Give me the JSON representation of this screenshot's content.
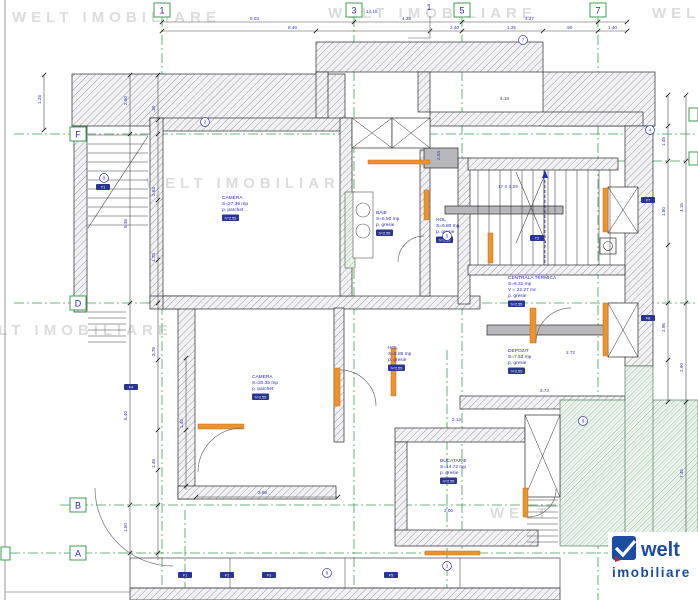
{
  "watermark": {
    "text": "WELT IMOBILIARE",
    "color": "#dcdcdc",
    "positions": [
      {
        "x": 12,
        "y": 22
      },
      {
        "x": 328,
        "y": 18
      },
      {
        "x": 652,
        "y": 18
      },
      {
        "x": 146,
        "y": 188
      },
      {
        "x": -36,
        "y": 335
      },
      {
        "x": 490,
        "y": 518
      }
    ]
  },
  "grid": {
    "line_color": "#3aa052",
    "top_bubbles": [
      {
        "label": "1",
        "x": 162
      },
      {
        "label": "3",
        "x": 354
      },
      {
        "label": "5",
        "x": 462
      },
      {
        "label": "7",
        "x": 598
      }
    ],
    "left_bubbles": [
      {
        "label": "F",
        "y": 134
      },
      {
        "label": "D",
        "y": 303
      },
      {
        "label": "B",
        "y": 505
      },
      {
        "label": "A",
        "y": 553
      }
    ]
  },
  "section_marker": "1",
  "stair_note": "17 X 0.29",
  "rooms": [
    {
      "name": "CAMERA",
      "area": "S=27.36 mp",
      "floor": "p. parchet",
      "badge": "h=2.55",
      "x": 222,
      "y": 199
    },
    {
      "name": "BAIE",
      "area": "S=6.50 mp",
      "floor": "p. gresie",
      "badge": "h=2.55",
      "x": 376,
      "y": 214
    },
    {
      "name": "HOL",
      "area": "S=6.80 mp",
      "floor": "p. gresie",
      "badge": "h=2.55",
      "x": 436,
      "y": 221
    },
    {
      "name": "CENTRALA TERMICA",
      "area": "S=6.31 mp",
      "volume": "V = 22.27 mc",
      "floor": "p. gresie",
      "badge": "h=2.55",
      "x": 508,
      "y": 279
    },
    {
      "name": "DEPOZIT",
      "area": "S=7.53 mp",
      "floor": "p. gresie",
      "badge": "h=2.55",
      "x": 508,
      "y": 352
    },
    {
      "name": "CAMERA",
      "area": "S=20.35 mp",
      "floor": "p. parchet",
      "badge": "h=2.55",
      "x": 252,
      "y": 378
    },
    {
      "name": "HOL",
      "area": "S=5.85 mp",
      "floor": "p. gresie",
      "badge": "h=2.55",
      "x": 388,
      "y": 349
    },
    {
      "name": "BUCATARIE",
      "area": "S=14.72 mp",
      "floor": "p. gresie",
      "badge": "h=2.55",
      "x": 440,
      "y": 462
    }
  ],
  "dim_labels": [
    {
      "t": "8.03",
      "x": 250,
      "y": 20
    },
    {
      "t": "14.15",
      "x": 366,
      "y": 13
    },
    {
      "t": "4.38",
      "x": 402,
      "y": 20
    },
    {
      "t": "4.27",
      "x": 525,
      "y": 20
    },
    {
      "t": "8.46",
      "x": 288,
      "y": 29
    },
    {
      "t": "2.40",
      "x": 450,
      "y": 29
    },
    {
      "t": "1.25",
      "x": 507,
      "y": 29
    },
    {
      "t": ".90",
      "x": 566,
      "y": 29
    },
    {
      "t": "1.40",
      "x": 608,
      "y": 29
    },
    {
      "t": "2.50",
      "x": 127,
      "y": 105,
      "r": -90
    },
    {
      "t": "5.36",
      "x": 127,
      "y": 228,
      "r": -90
    },
    {
      "t": "6.40",
      "x": 127,
      "y": 420,
      "r": -90
    },
    {
      "t": "1.50",
      "x": 127,
      "y": 532,
      "r": -90
    },
    {
      "t": ".30",
      "x": 155,
      "y": 112,
      "r": -90
    },
    {
      "t": "2.63",
      "x": 155,
      "y": 196,
      "r": -90
    },
    {
      "t": "1.78",
      "x": 155,
      "y": 262,
      "r": -90
    },
    {
      "t": "3.76",
      "x": 155,
      "y": 356,
      "r": -90
    },
    {
      "t": "1.46",
      "x": 155,
      "y": 468,
      "r": -90
    },
    {
      "t": "1.45",
      "x": 183,
      "y": 428,
      "r": -90
    },
    {
      "t": "3.98",
      "x": 258,
      "y": 494
    },
    {
      "t": "1.28",
      "x": 41,
      "y": 104,
      "r": -90
    },
    {
      "t": "1.45",
      "x": 665,
      "y": 146,
      "r": -90
    },
    {
      "t": "1.80",
      "x": 665,
      "y": 216,
      "r": -90
    },
    {
      "t": "2.96",
      "x": 665,
      "y": 332,
      "r": -90
    },
    {
      "t": "4.15",
      "x": 683,
      "y": 212,
      "r": -90
    },
    {
      "t": "2.90",
      "x": 683,
      "y": 372,
      "r": -90
    },
    {
      "t": "7.45",
      "x": 683,
      "y": 478,
      "r": -90
    },
    {
      "t": "2.72",
      "x": 566,
      "y": 354
    },
    {
      "t": "3.73",
      "x": 540,
      "y": 392
    },
    {
      "t": "2.13",
      "x": 452,
      "y": 421
    },
    {
      "t": "3.06",
      "x": 444,
      "y": 512
    },
    {
      "t": "4.18",
      "x": 500,
      "y": 100
    },
    {
      "t": "2.04",
      "x": 440,
      "y": 160,
      "r": -90
    }
  ],
  "circled_numbers": [
    {
      "n": "2",
      "x": 205,
      "y": 122
    },
    {
      "n": "9",
      "x": 104,
      "y": 178
    },
    {
      "n": "7",
      "x": 523,
      "y": 40
    },
    {
      "n": "4",
      "x": 650,
      "y": 130
    },
    {
      "n": "5",
      "x": 447,
      "y": 236
    },
    {
      "n": "8",
      "x": 327,
      "y": 573
    },
    {
      "n": "3",
      "x": 447,
      "y": 566
    },
    {
      "n": "6",
      "x": 583,
      "y": 421
    }
  ],
  "tag_badges": [
    {
      "t": "T1",
      "x": 96,
      "y": 184
    },
    {
      "t": "F4",
      "x": 124,
      "y": 384
    },
    {
      "t": "F1",
      "x": 178,
      "y": 572
    },
    {
      "t": "F2",
      "x": 220,
      "y": 572
    },
    {
      "t": "F3",
      "x": 262,
      "y": 572
    },
    {
      "t": "F5",
      "x": 384,
      "y": 572
    },
    {
      "t": "F7",
      "x": 641,
      "y": 197
    },
    {
      "t": "F8",
      "x": 641,
      "y": 315
    },
    {
      "t": "T2",
      "x": 530,
      "y": 235
    }
  ],
  "logo": {
    "line1": "welt",
    "line2": "imobiliare",
    "color": "#1b4da0",
    "check_icon": "check"
  },
  "colors": {
    "grid_green": "#3aa052",
    "annotation_blue": "#2b2bb8",
    "door_orange": "#ec9330",
    "watermark_gray": "#dcdcdc",
    "logo_blue": "#1b4da0"
  }
}
